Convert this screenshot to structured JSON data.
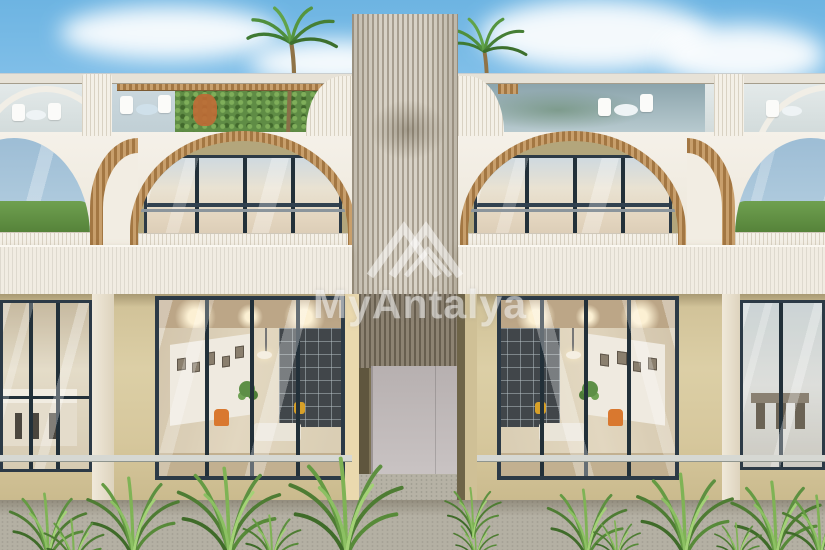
{
  "watermark": {
    "text": "MyAntalya",
    "logo_icon": "mountain-peaks-logo",
    "color": "rgba(255,255,255,0.5)"
  },
  "scene": {
    "type": "exterior-architectural-render",
    "elements": [
      "sky",
      "clouds",
      "palm-trees",
      "rooftop-terrace",
      "arched-balconies",
      "central-slat-tower",
      "glass-facade",
      "tropical-plants",
      "gravel-path"
    ]
  },
  "palette": {
    "sky_top": "#6db4e2",
    "sky_horizon": "#e9f5fc",
    "wall_white": "#f2ede3",
    "wall_beige": "#d6c79c",
    "wood_slats": "#c89f6c",
    "window_frame": "#2c3a46",
    "glass_reflection": "#9dbdd5",
    "plant_green": "#659b43",
    "armchair_orange": "#d9782f",
    "gravel": "#b4b0a3"
  }
}
